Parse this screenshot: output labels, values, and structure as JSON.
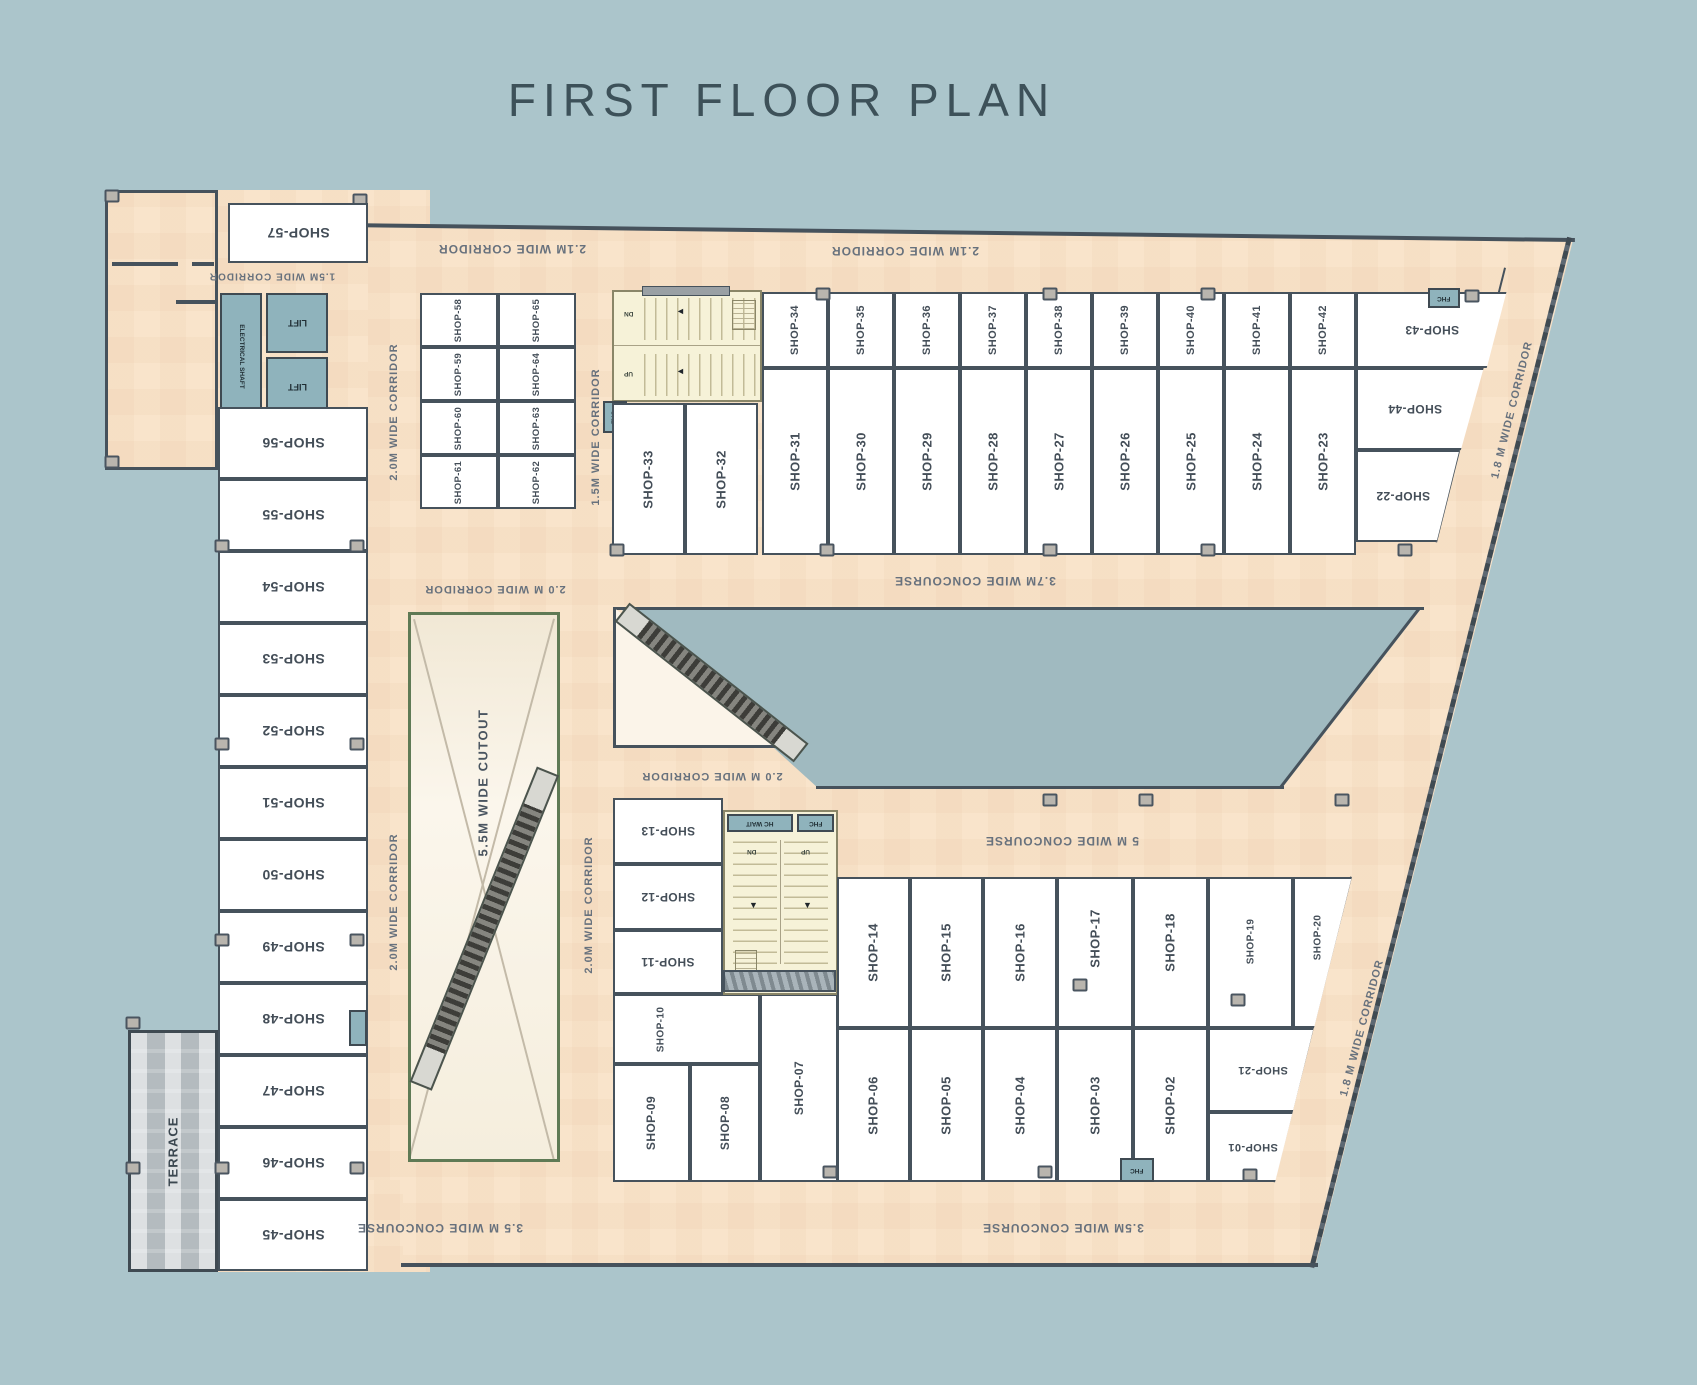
{
  "title": "FIRST FLOOR PLAN",
  "rooms": {
    "s01": "SHOP-01",
    "s02": "SHOP-02",
    "s03": "SHOP-03",
    "s04": "SHOP-04",
    "s05": "SHOP-05",
    "s06": "SHOP-06",
    "s07": "SHOP-07",
    "s08": "SHOP-08",
    "s09": "SHOP-09",
    "s10": "SHOP-10",
    "s11": "SHOP-11",
    "s12": "SHOP-12",
    "s13": "SHOP-13",
    "s14": "SHOP-14",
    "s15": "SHOP-15",
    "s16": "SHOP-16",
    "s17": "SHOP-17",
    "s18": "SHOP-18",
    "s19": "SHOP-19",
    "s20": "SHOP-20",
    "s21": "SHOP-21",
    "s22": "SHOP-22",
    "s23": "SHOP-23",
    "s24": "SHOP-24",
    "s25": "SHOP-25",
    "s26": "SHOP-26",
    "s27": "SHOP-27",
    "s28": "SHOP-28",
    "s29": "SHOP-29",
    "s30": "SHOP-30",
    "s31": "SHOP-31",
    "s32": "SHOP-32",
    "s33": "SHOP-33",
    "s34": "SHOP-34",
    "s35": "SHOP-35",
    "s36": "SHOP-36",
    "s37": "SHOP-37",
    "s38": "SHOP-38",
    "s39": "SHOP-39",
    "s40": "SHOP-40",
    "s41": "SHOP-41",
    "s42": "SHOP-42",
    "s43": "SHOP-43",
    "s44": "SHOP-44",
    "s45": "SHOP-45",
    "s46": "SHOP-46",
    "s47": "SHOP-47",
    "s48": "SHOP-48",
    "s49": "SHOP-49",
    "s50": "SHOP-50",
    "s51": "SHOP-51",
    "s52": "SHOP-52",
    "s53": "SHOP-53",
    "s54": "SHOP-54",
    "s55": "SHOP-55",
    "s56": "SHOP-56",
    "s57": "SHOP-57",
    "s58": "SHOP-58",
    "s59": "SHOP-59",
    "s60": "SHOP-60",
    "s61": "SHOP-61",
    "s62": "SHOP-62",
    "s63": "SHOP-63",
    "s64": "SHOP-64",
    "s65": "SHOP-65"
  },
  "labels": {
    "corridor_21_left": "2.1M WIDE CORRIDOR",
    "corridor_21_right": "2.1M WIDE CORRIDOR",
    "corridor_15_topleft": "1.5M WIDE CORRIDOR",
    "corridor_15_mid": "1.5M WIDE CORRIDOR",
    "corridor_20_leftwing_upper": "2.0M WIDE CORRIDOR",
    "corridor_20_leftwing_lower": "2.0M WIDE CORRIDOR",
    "corridor_20_above_cutout": "2.0 M WIDE CORRIDOR",
    "corridor_20_below_triangle": "2.0 M WIDE CORRIDOR",
    "corridor_20_right_of_cutout": "2.0M WIDE CORRIDOR",
    "cutout": "5.5M WIDE CUTOUT",
    "concourse_37": "3.7M  WIDE  CONCOURSE",
    "concourse_5": "5 M  WIDE CONCOURSE",
    "concourse_35_left": "3.5 M WIDE CONCOURSE",
    "concourse_35_right": "3.5M WIDE CONCOURSE",
    "corridor_18_top": "1.8 M  WIDE CORRIDOR",
    "corridor_18_bottom": "1.8 M  WIDE CORRIDOR",
    "terrace": "TERRACE",
    "electrical_shaft": "ELECTRICAL SHAFT",
    "lift": "LIFT",
    "hc_wait": "HC WAIT",
    "fhc": "FHC",
    "dn": "DN",
    "up": "UP"
  },
  "colors": {
    "background": "#abc5cb",
    "plan_fill": "#f9e4cb",
    "wall": "#46525c",
    "room_fill": "#ffffff",
    "service_blue": "#8fb3bc",
    "stairs_fill": "#f6f2d8",
    "cutout_border": "#5f7a55",
    "terrace_fill": "#b7bec2",
    "void_fill": "#a0bac0",
    "title_color": "#3d5159"
  }
}
